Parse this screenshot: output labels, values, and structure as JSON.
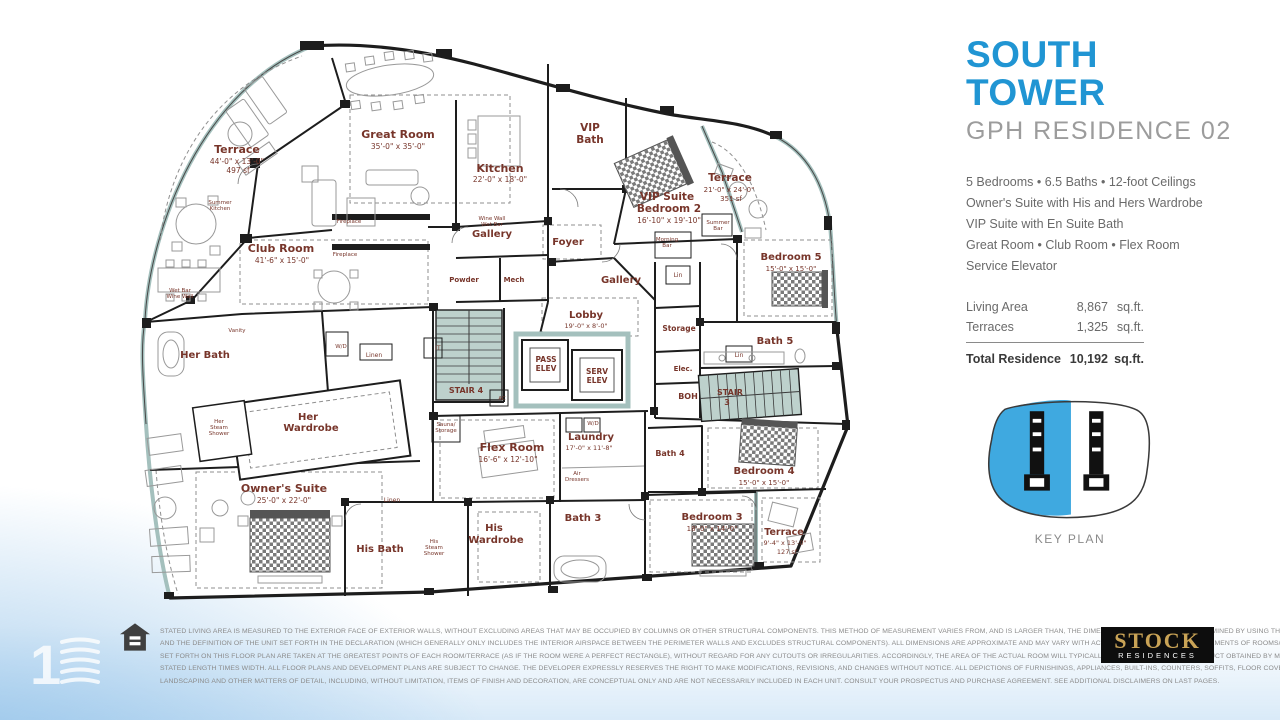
{
  "panel": {
    "title_line1": "SOUTH",
    "title_line2": "TOWER",
    "subtitle": "GPH RESIDENCE 02",
    "accent_color": "#2095d3",
    "keyplan_fill": "#3fa9e0",
    "features": [
      "5 Bedrooms • 6.5 Baths • 12-foot Ceilings",
      "Owner's Suite with His and Hers Wardrobe",
      "VIP Suite with En Suite Bath",
      "Great Room • Club Room • Flex Room",
      "Service Elevator"
    ],
    "areas": {
      "rows": [
        {
          "label": "Living Area",
          "value": "8,867",
          "unit": "sq.ft."
        },
        {
          "label": "Terraces",
          "value": "1,325",
          "unit": "sq.ft."
        }
      ],
      "total": {
        "label": "Total Residence",
        "value": "10,192",
        "unit": "sq.ft."
      }
    },
    "key_plan_label": "KEY PLAN"
  },
  "floorplan": {
    "label_color": "#77352a",
    "labels": [
      {
        "t": "Terrace",
        "x": 237,
        "y": 153,
        "s": 11,
        "b": 1
      },
      {
        "t": "44'-0\" x 13'-0\"",
        "x": 237,
        "y": 164,
        "s": 7.5
      },
      {
        "t": "497 sf",
        "x": 238,
        "y": 173,
        "s": 7.5
      },
      {
        "t": "Great Room",
        "x": 398,
        "y": 138,
        "s": 11,
        "b": 1
      },
      {
        "t": "35'-0\" x 35'-0\"",
        "x": 398,
        "y": 149,
        "s": 7.5
      },
      {
        "t": "Kitchen",
        "x": 500,
        "y": 172,
        "s": 11,
        "b": 1
      },
      {
        "t": "22'-0\" x 18'-0\"",
        "x": 500,
        "y": 182,
        "s": 7.5
      },
      {
        "t": "VIP",
        "x": 590,
        "y": 131,
        "s": 10.5,
        "b": 1
      },
      {
        "t": "Bath",
        "x": 590,
        "y": 143,
        "s": 10.5,
        "b": 1
      },
      {
        "t": "VIP Suite",
        "x": 667,
        "y": 200,
        "s": 10.5,
        "b": 1
      },
      {
        "t": "Bedroom 2",
        "x": 669,
        "y": 212,
        "s": 10.5,
        "b": 1
      },
      {
        "t": "16'-10\" x 19'-10\"",
        "x": 669,
        "y": 223,
        "s": 7.5
      },
      {
        "t": "Terrace",
        "x": 730,
        "y": 181,
        "s": 10.5,
        "b": 1
      },
      {
        "t": "21'-0\" x 24'-0\"",
        "x": 729,
        "y": 192,
        "s": 7
      },
      {
        "t": "351 sf",
        "x": 731,
        "y": 201,
        "s": 7
      },
      {
        "t": "Club Room",
        "x": 281,
        "y": 252,
        "s": 11,
        "b": 1
      },
      {
        "t": "41'-6\" x 15'-0\"",
        "x": 282,
        "y": 263,
        "s": 7.5
      },
      {
        "t": "Gallery",
        "x": 492,
        "y": 237,
        "s": 10,
        "b": 1
      },
      {
        "t": "Foyer",
        "x": 568,
        "y": 245,
        "s": 10,
        "b": 1
      },
      {
        "t": "Gallery",
        "x": 621,
        "y": 283,
        "s": 10,
        "b": 1
      },
      {
        "t": "Bedroom 5",
        "x": 791,
        "y": 260,
        "s": 10,
        "b": 1
      },
      {
        "t": "15'-0\" x 15'-0\"",
        "x": 791,
        "y": 271,
        "s": 7
      },
      {
        "t": "Powder",
        "x": 464,
        "y": 282,
        "s": 7,
        "b": 1
      },
      {
        "t": "Mech",
        "x": 514,
        "y": 282,
        "s": 7,
        "b": 1
      },
      {
        "t": "Lobby",
        "x": 586,
        "y": 318,
        "s": 10,
        "b": 1
      },
      {
        "t": "19'-0\" x 8'-0\"",
        "x": 586,
        "y": 328,
        "s": 6.5
      },
      {
        "t": "Storage",
        "x": 679,
        "y": 331,
        "s": 7.5,
        "b": 1
      },
      {
        "t": "Bath 5",
        "x": 775,
        "y": 344,
        "s": 10,
        "b": 1
      },
      {
        "t": "PASS",
        "x": 546,
        "y": 362,
        "s": 7.5,
        "b": 1
      },
      {
        "t": "ELEV",
        "x": 546,
        "y": 371,
        "s": 7.5,
        "b": 1
      },
      {
        "t": "SERV",
        "x": 597,
        "y": 374,
        "s": 7.5,
        "b": 1
      },
      {
        "t": "ELEV",
        "x": 597,
        "y": 383,
        "s": 7.5,
        "b": 1
      },
      {
        "t": "STAIR 4",
        "x": 466,
        "y": 393,
        "s": 8,
        "b": 1
      },
      {
        "t": "Elec.",
        "x": 683,
        "y": 371,
        "s": 7,
        "b": 1
      },
      {
        "t": "BOH",
        "x": 688,
        "y": 399,
        "s": 8,
        "b": 1
      },
      {
        "t": "STAIR",
        "x": 730,
        "y": 395,
        "s": 8,
        "b": 1
      },
      {
        "t": "3",
        "x": 727,
        "y": 405,
        "s": 8,
        "b": 1
      },
      {
        "t": "Her Bath",
        "x": 205,
        "y": 358,
        "s": 10,
        "b": 1
      },
      {
        "t": "Her",
        "x": 308,
        "y": 420,
        "s": 10,
        "b": 1
      },
      {
        "t": "Wardrobe",
        "x": 311,
        "y": 431,
        "s": 10,
        "b": 1
      },
      {
        "t": "Her",
        "x": 219,
        "y": 423,
        "s": 5.5
      },
      {
        "t": "Steam",
        "x": 219,
        "y": 429,
        "s": 5.5
      },
      {
        "t": "Shower",
        "x": 219,
        "y": 435,
        "s": 5.5
      },
      {
        "t": "Owner's Suite",
        "x": 284,
        "y": 492,
        "s": 11,
        "b": 1
      },
      {
        "t": "25'-0\" x 22'-0\"",
        "x": 284,
        "y": 503,
        "s": 7.5
      },
      {
        "t": "Flex Room",
        "x": 512,
        "y": 451,
        "s": 11,
        "b": 1
      },
      {
        "t": "16'-6\" x 12'-10\"",
        "x": 508,
        "y": 462,
        "s": 7.5
      },
      {
        "t": "Laundry",
        "x": 591,
        "y": 440,
        "s": 10,
        "b": 1
      },
      {
        "t": "17'-0\" x 11'-8\"",
        "x": 589,
        "y": 450,
        "s": 6.5
      },
      {
        "t": "Air",
        "x": 577,
        "y": 475,
        "s": 5.5
      },
      {
        "t": "Dressers",
        "x": 577,
        "y": 481,
        "s": 5.5
      },
      {
        "t": "His Bath",
        "x": 380,
        "y": 552,
        "s": 10,
        "b": 1
      },
      {
        "t": "His",
        "x": 434,
        "y": 543,
        "s": 5.5
      },
      {
        "t": "Steam",
        "x": 434,
        "y": 549,
        "s": 5.5
      },
      {
        "t": "Shower",
        "x": 434,
        "y": 555,
        "s": 5.5
      },
      {
        "t": "His",
        "x": 494,
        "y": 531,
        "s": 10,
        "b": 1
      },
      {
        "t": "Wardrobe",
        "x": 496,
        "y": 543,
        "s": 10,
        "b": 1
      },
      {
        "t": "Linen",
        "x": 392,
        "y": 502,
        "s": 6
      },
      {
        "t": "Bath 3",
        "x": 583,
        "y": 521,
        "s": 10,
        "b": 1
      },
      {
        "t": "Bath 4",
        "x": 670,
        "y": 456,
        "s": 8,
        "b": 1
      },
      {
        "t": "Bedroom 4",
        "x": 764,
        "y": 474,
        "s": 10,
        "b": 1
      },
      {
        "t": "15'-0\" x 15'-0\"",
        "x": 764,
        "y": 485,
        "s": 7
      },
      {
        "t": "Bedroom 3",
        "x": 712,
        "y": 520,
        "s": 10,
        "b": 1
      },
      {
        "t": "18'-0\" x 14'-0\"",
        "x": 712,
        "y": 531,
        "s": 7
      },
      {
        "t": "Terrace",
        "x": 784,
        "y": 535,
        "s": 9.5,
        "b": 1
      },
      {
        "t": "9'-4\" x 13'-0\"",
        "x": 785,
        "y": 545,
        "s": 6.5
      },
      {
        "t": "127 sf",
        "x": 787,
        "y": 554,
        "s": 6.5
      },
      {
        "t": "Summer",
        "x": 220,
        "y": 204,
        "s": 5.5
      },
      {
        "t": "Kitchen",
        "x": 220,
        "y": 210,
        "s": 5.5
      },
      {
        "t": "Wet Bar",
        "x": 180,
        "y": 292,
        "s": 5.5
      },
      {
        "t": "Wine Wall",
        "x": 180,
        "y": 298,
        "s": 5.5
      },
      {
        "t": "Fireplace",
        "x": 349,
        "y": 223,
        "s": 5.5
      },
      {
        "t": "Fireplace",
        "x": 345,
        "y": 256,
        "s": 5.5
      },
      {
        "t": "Wine Wall",
        "x": 492,
        "y": 220,
        "s": 5.5
      },
      {
        "t": "Wet Bar",
        "x": 492,
        "y": 226,
        "s": 5.5
      },
      {
        "t": "Morning",
        "x": 667,
        "y": 241,
        "s": 5.5
      },
      {
        "t": "Bar",
        "x": 667,
        "y": 247,
        "s": 5.5
      },
      {
        "t": "Summer",
        "x": 718,
        "y": 224,
        "s": 5.5
      },
      {
        "t": "Bar",
        "x": 718,
        "y": 230,
        "s": 5.5
      },
      {
        "t": "Lin",
        "x": 678,
        "y": 277,
        "s": 6
      },
      {
        "t": "Lin",
        "x": 739,
        "y": 357,
        "s": 6
      },
      {
        "t": "Linen",
        "x": 374,
        "y": 357,
        "s": 6
      },
      {
        "t": "Vanity",
        "x": 237,
        "y": 332,
        "s": 5.5
      },
      {
        "t": "W/D",
        "x": 341,
        "y": 348,
        "s": 5.5
      },
      {
        "t": "Sauna/",
        "x": 446,
        "y": 426,
        "s": 5.5
      },
      {
        "t": "Storage",
        "x": 446,
        "y": 432,
        "s": 5.5
      },
      {
        "t": "W/D",
        "x": 593,
        "y": 425,
        "s": 5.5
      },
      {
        "t": "IT",
        "x": 438,
        "y": 350,
        "s": 6
      },
      {
        "t": "AC",
        "x": 502,
        "y": 400,
        "s": 5.5
      }
    ]
  },
  "footer": {
    "disclaimer_lines": [
      "STATED LIVING AREA IS MEASURED TO THE EXTERIOR FACE OF EXTERIOR WALLS, WITHOUT EXCLUDING AREAS THAT MAY BE OCCUPIED BY COLUMNS OR OTHER STRUCTURAL COMPONENTS. THIS METHOD OF MEASUREMENT VARIES FROM, AND IS LARGER THAN, THE DIMENSIONS THAT WOULD BE DETERMINED BY USING THE DESCRIPTION",
      "AND THE DEFINITION OF THE UNIT SET FORTH IN THE DECLARATION (WHICH GENERALLY ONLY INCLUDES THE INTERIOR AIRSPACE BETWEEN THE PERIMETER WALLS AND EXCLUDES STRUCTURAL COMPONENTS). ALL DIMENSIONS ARE APPROXIMATE AND MAY VARY WITH ACTUAL CONSTRUCTION. MEASUREMENTS OF ROOMS/TERRACES",
      "SET FORTH ON THIS FLOOR PLAN ARE TAKEN AT THE GREATEST POINTS OF EACH ROOM/TERRACE (AS IF THE ROOM WERE A PERFECT RECTANGLE), WITHOUT REGARD FOR ANY CUTOUTS OR IRREGULARITIES. ACCORDINGLY, THE AREA OF THE ACTUAL ROOM WILL TYPICALLY BE SMALLER THAN THE PRODUCT OBTAINED BY MULTIPLYING THE",
      "STATED LENGTH TIMES WIDTH. ALL FLOOR PLANS AND DEVELOPMENT PLANS ARE SUBJECT TO CHANGE. THE DEVELOPER EXPRESSLY RESERVES THE RIGHT TO MAKE MODIFICATIONS, REVISIONS, AND CHANGES WITHOUT NOTICE. ALL DEPICTIONS OF FURNISHINGS, APPLIANCES, BUILT-INS, COUNTERS, SOFFITS, FLOOR COVERINGS, LIGHTING,",
      "LANDSCAPING AND OTHER MATTERS OF DETAIL, INCLUDING, WITHOUT LIMITATION, ITEMS OF FINISH AND DECORATION, ARE CONCEPTUAL ONLY AND ARE NOT NECESSARILY INCLUDED IN EACH UNIT. CONSULT YOUR PROSPECTUS AND PURCHASE AGREEMENT. SEE ADDITIONAL DISCLAIMERS ON LAST PAGES.",
      "STATED LIVING AREA DISCLAIMER"
    ],
    "logo_title": "STOCK",
    "logo_subtitle": "RESIDENCES",
    "watermark_numeral": "1"
  }
}
